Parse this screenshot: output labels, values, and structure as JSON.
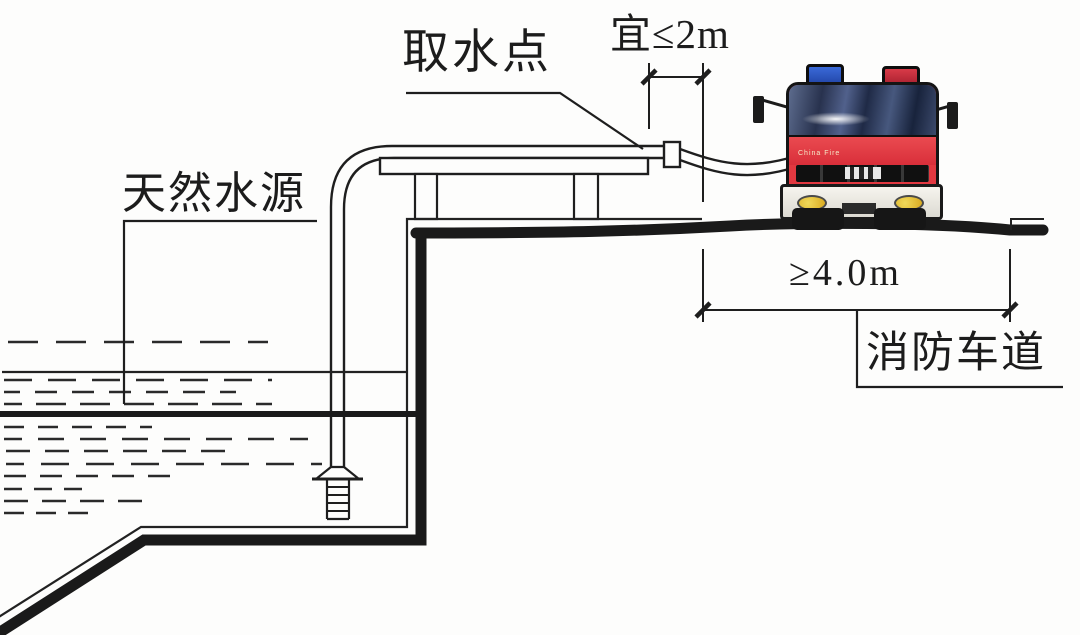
{
  "page": {
    "type": "fire-safety-water-intake-diagram",
    "background": "#fdfdfc"
  },
  "labels": {
    "intake_point": "取水点",
    "natural_water_source": "天然水源",
    "fire_lane": "消防车道"
  },
  "dimensions": {
    "intake_offset": "宜≤2m",
    "lane_width": "≥4.0m"
  },
  "truck": {
    "front_text": "China Fire"
  },
  "colors": {
    "line": "#1e1e1e",
    "truck_red": "#e23840",
    "beacon_blue": "#2853c0",
    "beacon_red": "#c22737",
    "headlight_yellow": "#e6c22e",
    "windshield_blue": "#2e3a55"
  }
}
